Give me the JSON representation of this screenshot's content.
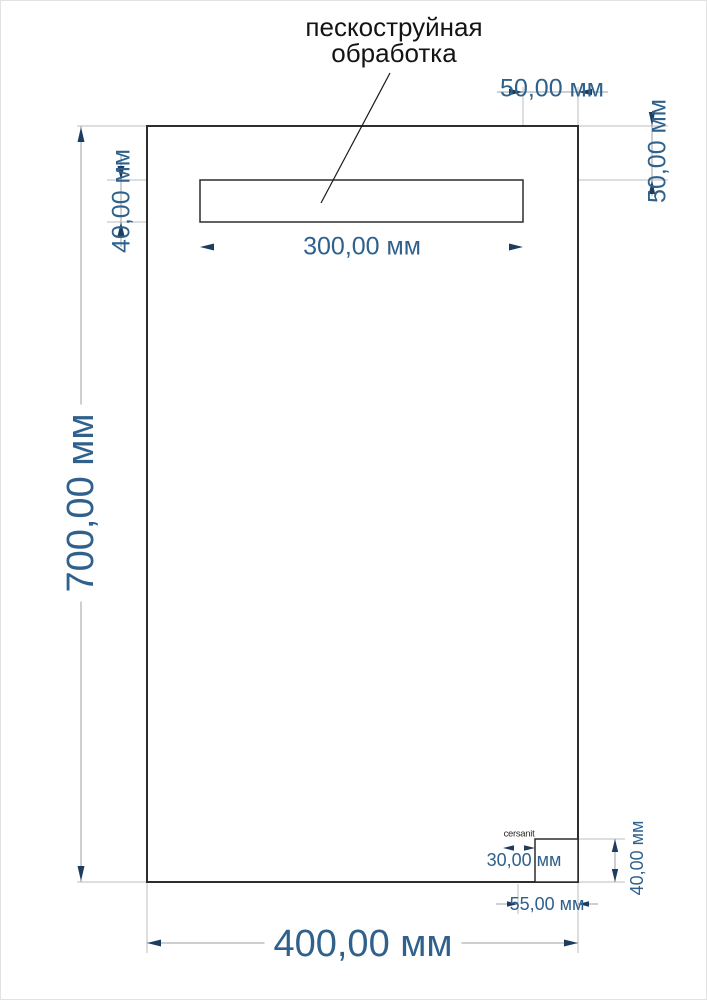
{
  "drawing": {
    "annotation": {
      "line1": "пескоструйная",
      "line2": "обработка"
    },
    "logo_text": "cersanit",
    "dims": {
      "mirror_height": "700,00 мм",
      "mirror_width": "400,00 мм",
      "strip_width": "300,00 мм",
      "strip_height": "40,00 мм",
      "strip_offset_right": "50,00 мм",
      "strip_offset_top": "50,00 мм",
      "logo_width": "30,00 мм",
      "logo_offset_right": "55,00 мм",
      "logo_offset_bottom": "40,00 мм"
    },
    "colors": {
      "dim_text": "#2f618c",
      "arrow": "#1c3d60",
      "ext_line": "#b8bcbf",
      "dim_line": "#9ba1a6",
      "outline": "#2d2d2d",
      "label": "#141414",
      "background": "#ffffff"
    }
  }
}
